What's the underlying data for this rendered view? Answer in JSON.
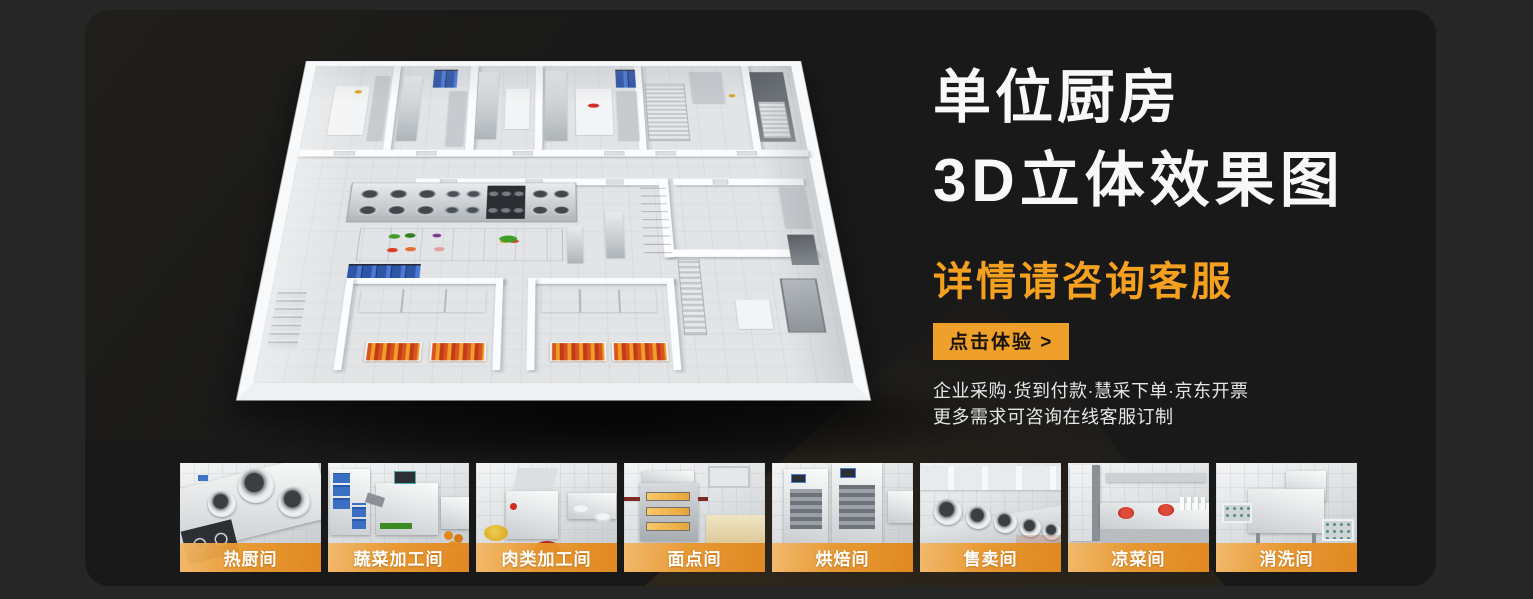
{
  "hero": {
    "title_line1": "单位厨房",
    "title_line2": "3D立体效果图",
    "subtitle": "详情请咨询客服",
    "cta_label": "点击体验 >",
    "feature_line1": "企业采购·货到付款·慧采下单·京东开票",
    "feature_line2": "更多需求可咨询在线客服订制"
  },
  "colors": {
    "page_background": "#262626",
    "card_background": "#191919",
    "accent_orange": "#f5a11f",
    "button_orange": "#efa02a",
    "banner_orange": "#e8962a",
    "title_white": "#f8f8f8"
  },
  "gallery": {
    "items": [
      {
        "label": "热厨间"
      },
      {
        "label": "蔬菜加工间"
      },
      {
        "label": "肉类加工间"
      },
      {
        "label": "面点间"
      },
      {
        "label": "烘焙间"
      },
      {
        "label": "售卖间"
      },
      {
        "label": "凉菜间"
      },
      {
        "label": "消洗间"
      }
    ]
  }
}
